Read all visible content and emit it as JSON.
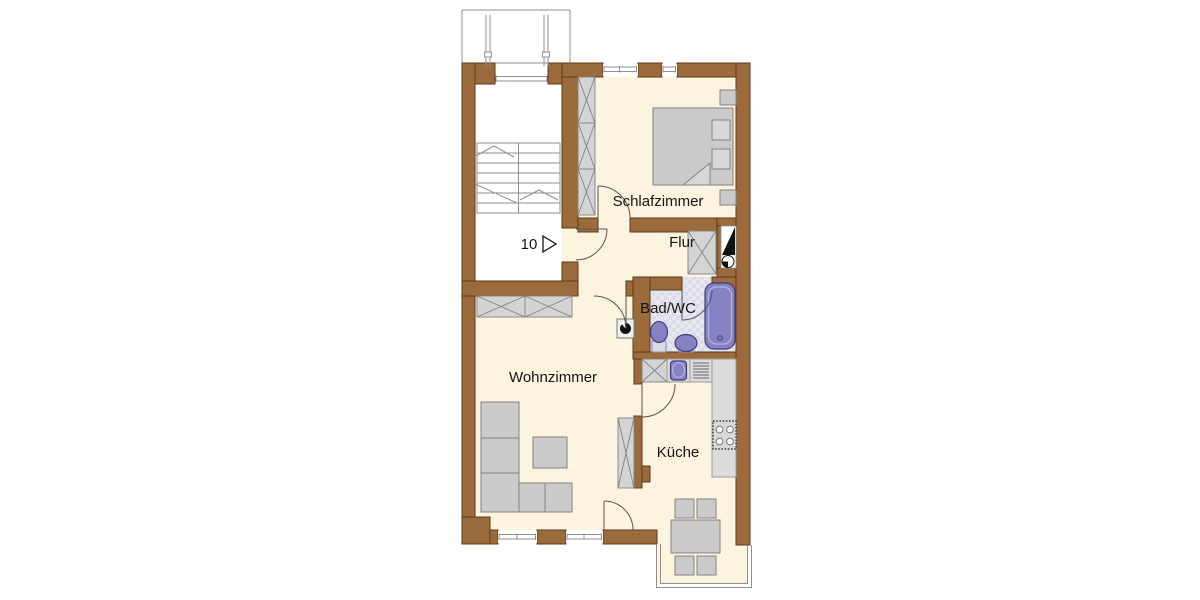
{
  "floor_plan": {
    "apartment_number": "10",
    "rooms": [
      {
        "id": "bedroom",
        "label": "Schlafzimmer"
      },
      {
        "id": "hallway",
        "label": "Flur"
      },
      {
        "id": "bathroom",
        "label": "Bad/WC"
      },
      {
        "id": "living-room",
        "label": "Wohnzimmer"
      },
      {
        "id": "kitchen",
        "label": "Küche"
      }
    ],
    "fixtures": [
      "elevator",
      "staircase",
      "entrance-door",
      "wardrobe",
      "double-bed",
      "nightstand",
      "installation-shaft",
      "bathtub",
      "washbasin",
      "toilet",
      "washing-machine",
      "kitchen-sink",
      "drainer",
      "stove",
      "counter",
      "sofa",
      "coffee-table",
      "dining-table",
      "chair",
      "bay-window"
    ]
  },
  "colors": {
    "background": "#ffffff",
    "wall": "#9c6b3c",
    "wall_outline": "#5a3a1c",
    "floor": "#fdf4e0",
    "bath_floor": "#e7e7ef",
    "bath_floor_alt": "#dddde7",
    "furniture_fill": "#cbcbcb",
    "furniture_outline": "#828282",
    "cabinet_fill": "#d4d4d4",
    "counter_fill": "#dcdcdc",
    "fixture_fill": "#8583c4",
    "fixture_outline": "#3f3d7a",
    "line": "#8f8f8f",
    "door_line": "#555555",
    "text": "#141414",
    "shaft": "#111111"
  }
}
